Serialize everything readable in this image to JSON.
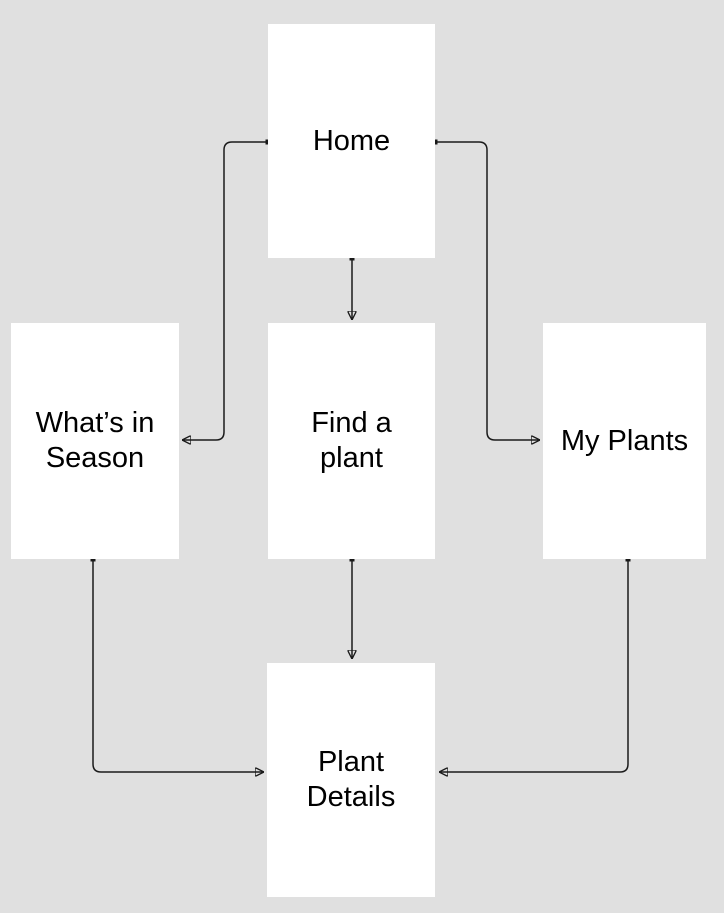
{
  "colors": {
    "background": "#e0e0e0",
    "node_fill": "#ffffff",
    "connector": "#1a1a1a",
    "text": "#000000"
  },
  "diagram": {
    "title": "App screen flow diagram",
    "nodes": {
      "home": {
        "label": "Home"
      },
      "whats_in_season": {
        "label": "What’s in\nSeason"
      },
      "find_a_plant": {
        "label": "Find a\nplant"
      },
      "my_plants": {
        "label": "My Plants"
      },
      "plant_details": {
        "label": "Plant\nDetails"
      }
    },
    "edges": [
      {
        "from": "Home",
        "to": "What’s in Season"
      },
      {
        "from": "Home",
        "to": "Find a plant"
      },
      {
        "from": "Home",
        "to": "My Plants"
      },
      {
        "from": "Find a plant",
        "to": "Plant Details"
      },
      {
        "from": "What’s in Season",
        "to": "Plant Details"
      },
      {
        "from": "My Plants",
        "to": "Plant Details"
      }
    ]
  }
}
